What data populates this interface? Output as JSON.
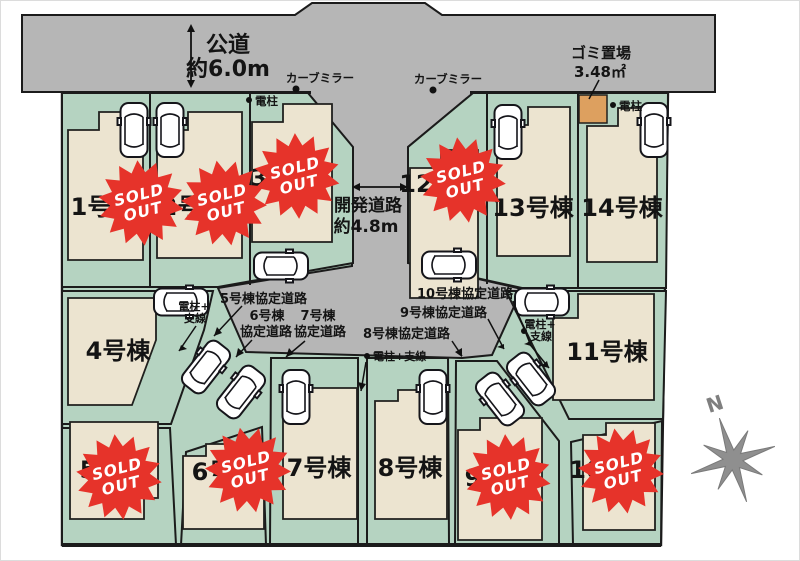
{
  "colors": {
    "road": "#b6b6b6",
    "lot": "#b5d3c1",
    "building": "#ece4d0",
    "sold": "#e6332a",
    "trash": "#dda05f",
    "outline": "#1b1b1b",
    "compass": "#8f8f8f"
  },
  "roads": {
    "public_road": {
      "name": "公道",
      "width": "約6.0m"
    },
    "development_road": {
      "name": "開発道路",
      "width": "約4.8m"
    }
  },
  "markers": {
    "curve_mirror": "カーブミラー",
    "utility_pole": "電柱",
    "utility_pole_wire": {
      "full": "電柱+支線",
      "line1": "電柱+",
      "line2": "支線"
    },
    "trash_area": {
      "label": "ゴミ置場",
      "size": "3.48㎡"
    },
    "compass_north": "N"
  },
  "agreement_roads": {
    "r5": {
      "label": "5号棟協定道路"
    },
    "r6": {
      "line1": "6号棟",
      "line2": "協定道路"
    },
    "r7": {
      "line1": "7号棟",
      "line2": "協定道路"
    },
    "r8": {
      "label": "8号棟協定道路"
    },
    "r9": {
      "label": "9号棟協定道路"
    },
    "r10": {
      "label": "10号棟協定道路"
    }
  },
  "lots": [
    {
      "id": 1,
      "label": "1号棟",
      "sold": true
    },
    {
      "id": 2,
      "label": "2号棟",
      "sold": true
    },
    {
      "id": 3,
      "label": "3号棟",
      "sold": true
    },
    {
      "id": 4,
      "label": "4号棟",
      "sold": false
    },
    {
      "id": 5,
      "label": "5号棟",
      "sold": true
    },
    {
      "id": 6,
      "label": "6号棟",
      "sold": true
    },
    {
      "id": 7,
      "label": "7号棟",
      "sold": false
    },
    {
      "id": 8,
      "label": "8号棟",
      "sold": false
    },
    {
      "id": 9,
      "label": "9号棟",
      "sold": true
    },
    {
      "id": 10,
      "label": "10号棟",
      "sold": true
    },
    {
      "id": 11,
      "label": "11号棟",
      "sold": false
    },
    {
      "id": 12,
      "label": "12号棟",
      "sold": true
    },
    {
      "id": 13,
      "label": "13号棟",
      "sold": false
    },
    {
      "id": 14,
      "label": "14号棟",
      "sold": false
    }
  ],
  "sold_badge": {
    "line1": "SOLD",
    "line2": "OUT"
  }
}
